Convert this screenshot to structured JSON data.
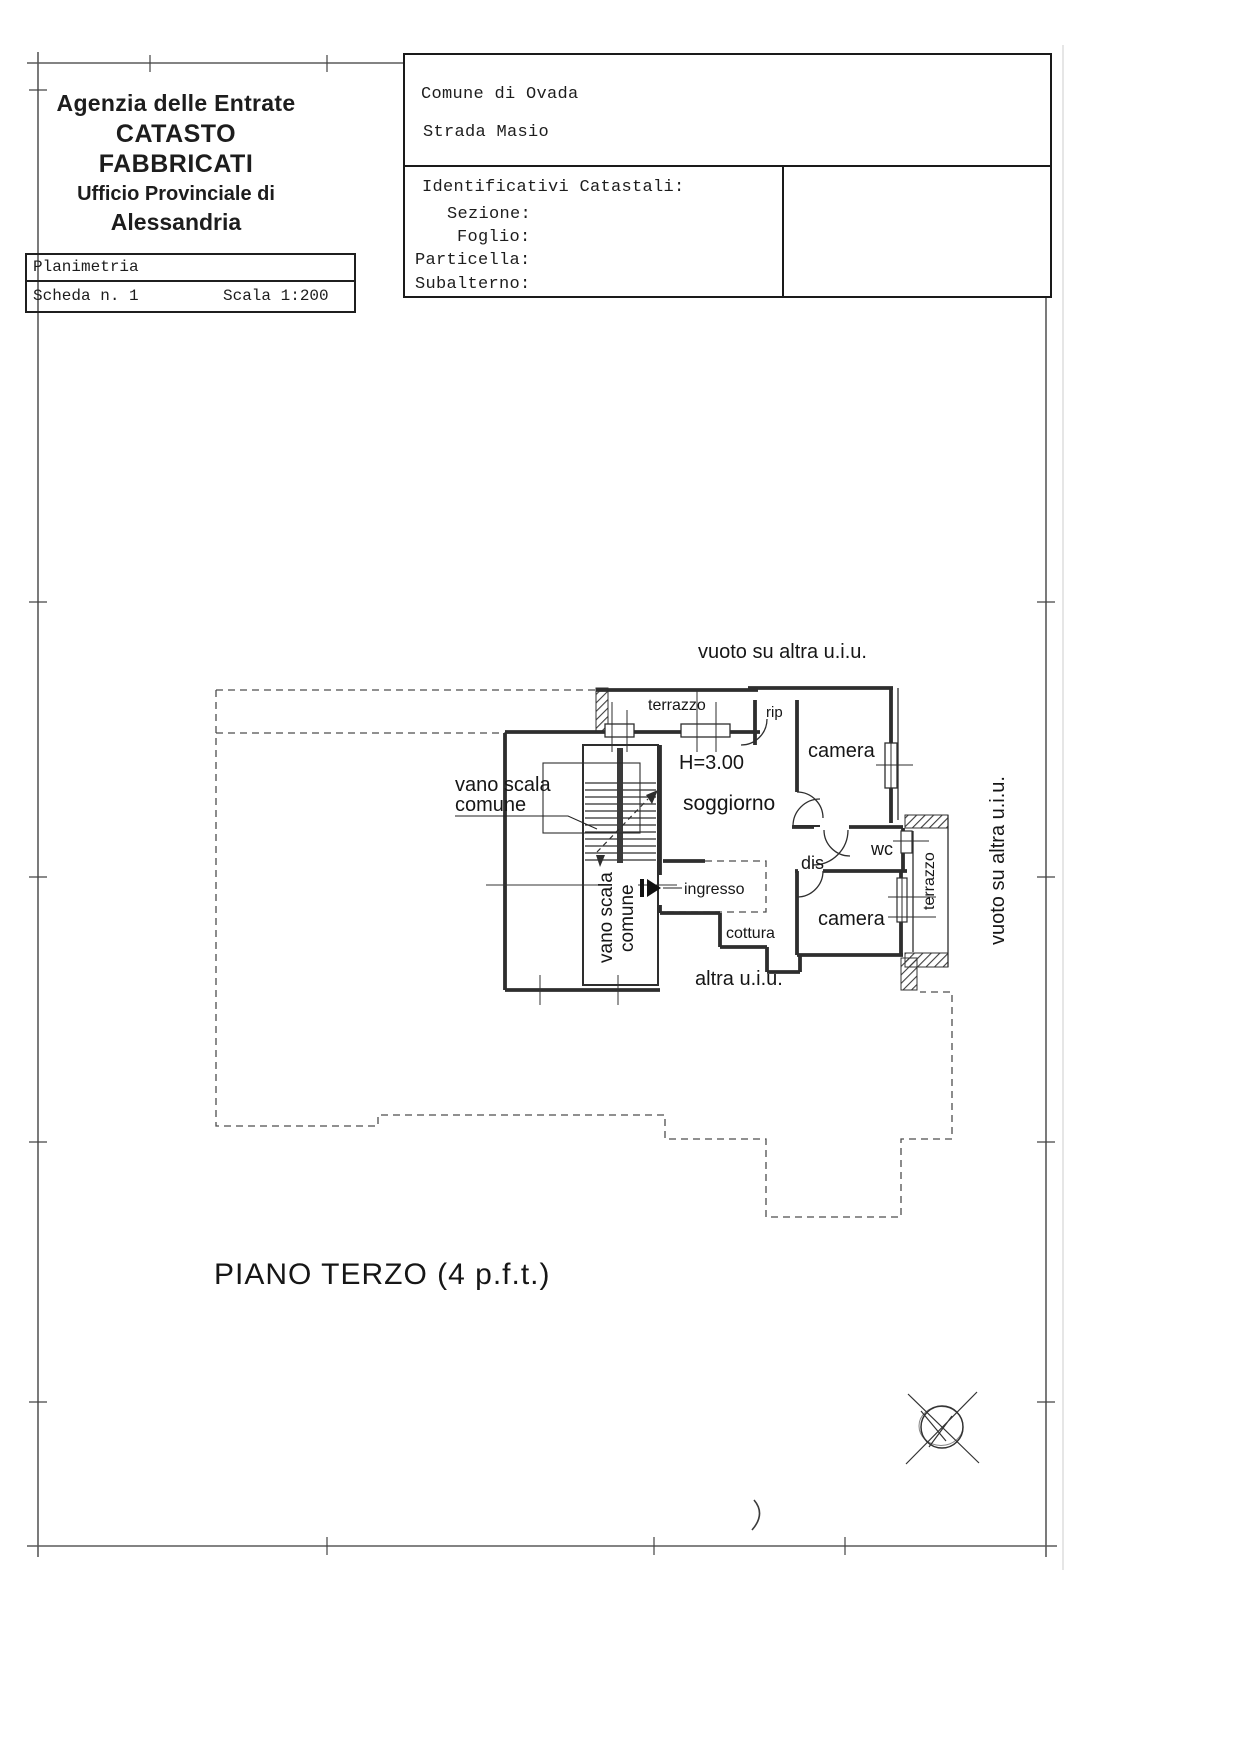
{
  "agency": {
    "line1": "Agenzia delle Entrate",
    "line2": "CATASTO FABBRICATI",
    "line3": "Ufficio Provinciale di",
    "line4": "Alessandria"
  },
  "plan_card": {
    "title": "Planimetria",
    "sheet": "Scheda n. 1",
    "scale": "Scala 1:200"
  },
  "cadastre": {
    "comune": "Comune di Ovada",
    "address": "Strada Masio",
    "ids_title": "Identificativi Catastali:",
    "fields": {
      "sezione": "Sezione:",
      "foglio": "Foglio:",
      "particella": "Particella:",
      "subalterno": "Subalterno:"
    }
  },
  "plan": {
    "vuoto": "vuoto su altra u.i.u.",
    "terrazzo": "terrazzo",
    "rip": "rip",
    "camera": "camera",
    "height": "H=3.00",
    "soggiorno": "soggiorno",
    "vano_scala_l1": "vano scala",
    "vano_scala_l2": "comune",
    "ingresso": "ingresso",
    "cottura": "cottura",
    "dis": "dis",
    "wc": "wc",
    "altra": "altra u.i.u.",
    "floor_title": "PIANO TERZO (4 p.f.t.)"
  },
  "colors": {
    "wall": "#2e2e2e",
    "dashed": "#4d4d4d",
    "frame": "#5a5a5a",
    "text": "#161616"
  }
}
